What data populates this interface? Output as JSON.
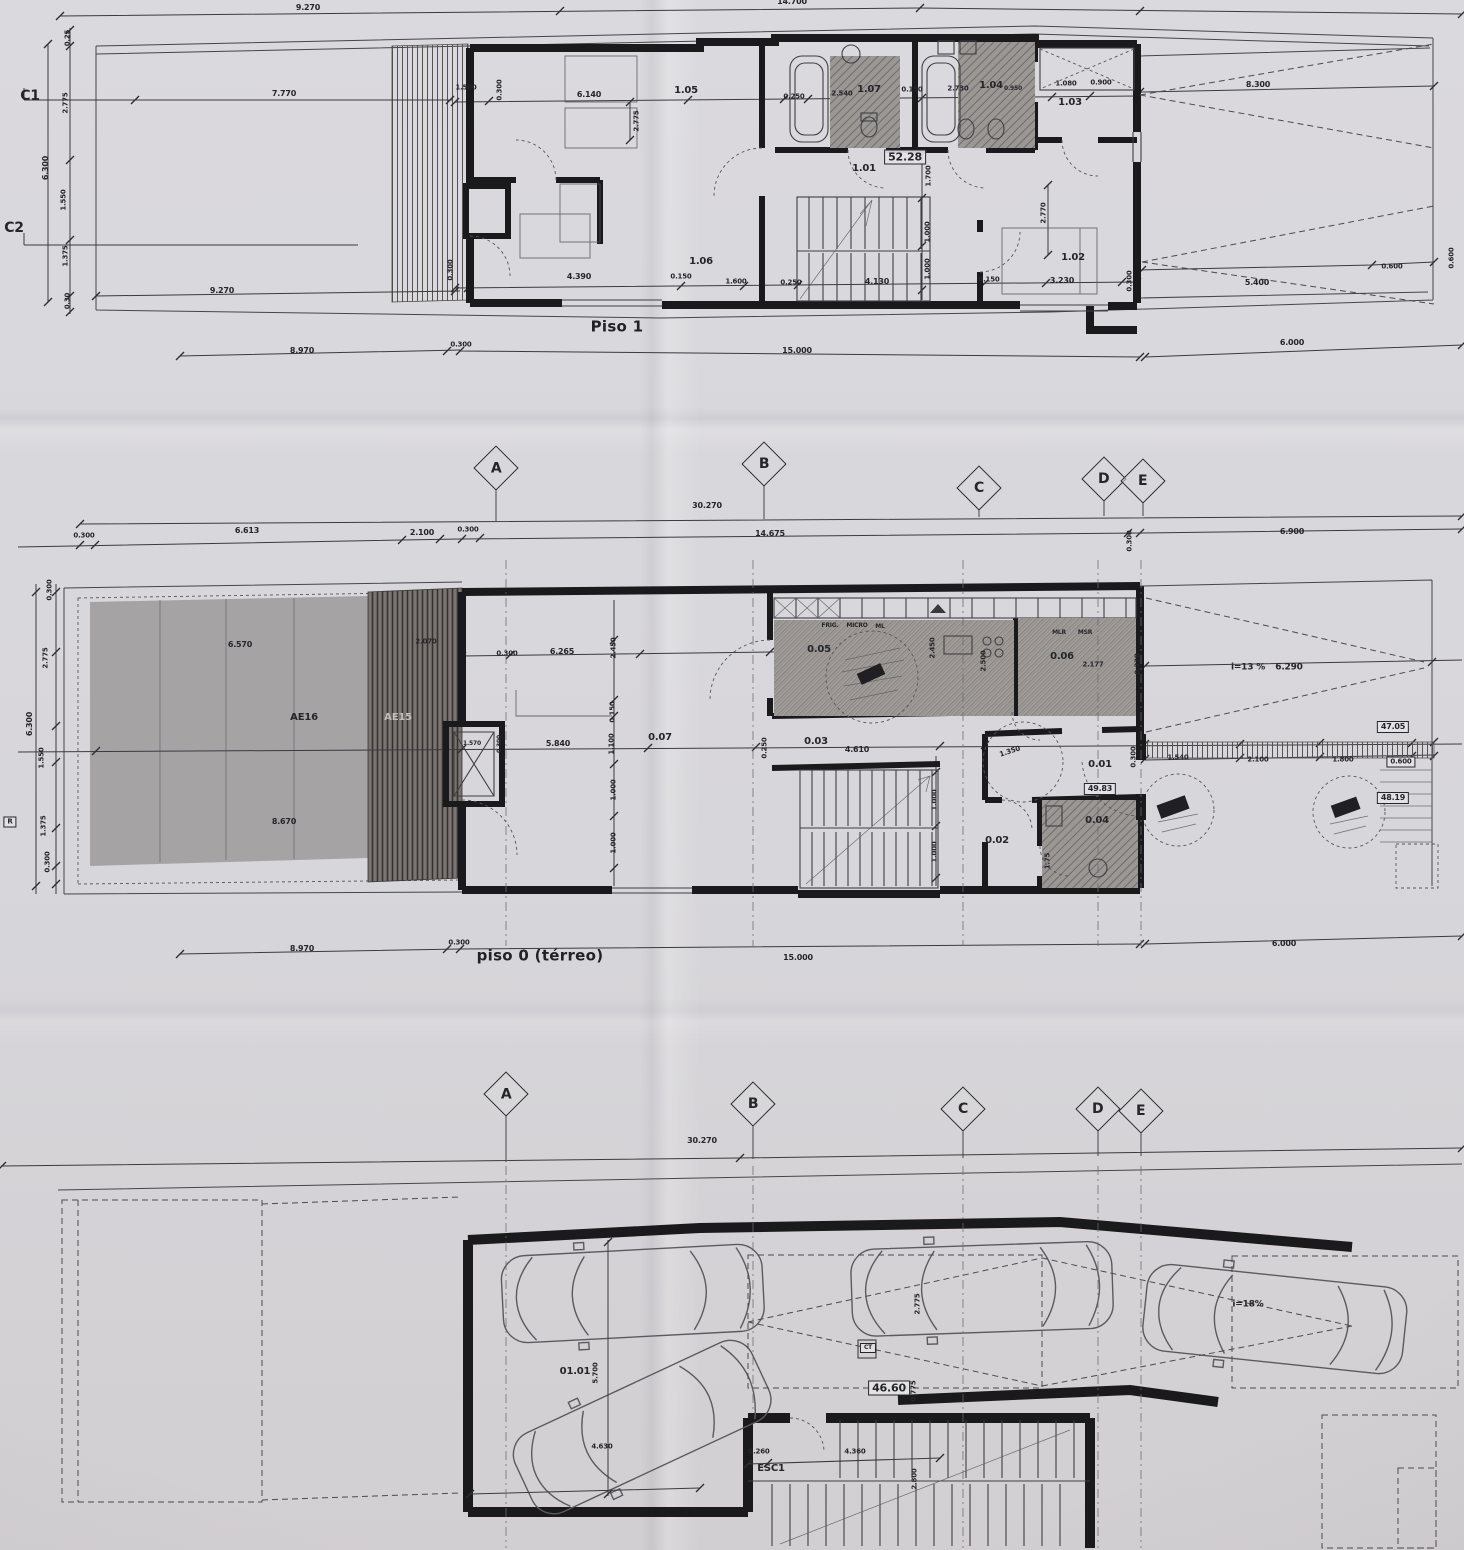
{
  "colors": {
    "paper": "#d8d7db",
    "ink": "#26262a",
    "wall": "#1a1a1c",
    "garden": "#a6a3a4",
    "deck": "#6e6966",
    "hatch": "#99948f"
  },
  "plans": {
    "piso1": {
      "title": "Piso 1",
      "rooms": [
        "1.01",
        "1.02",
        "1.03",
        "1.04",
        "1.05",
        "1.06",
        "1.07"
      ],
      "area": "52.28"
    },
    "piso0": {
      "title": "piso 0 (térreo)",
      "rooms": [
        "0.01",
        "0.02",
        "0.03",
        "0.04",
        "0.05",
        "0.06",
        "0.07"
      ],
      "zones": [
        "AE16",
        "AE15"
      ],
      "areas": [
        "49.83",
        "47.05",
        "48.19"
      ],
      "ramp_slope": "i=13 %"
    },
    "basement": {
      "rooms": [
        "01.01"
      ],
      "area": "46.60",
      "stairs": "ESC1",
      "ramp_slope": "i=18%"
    }
  },
  "grid_rows": [
    {
      "markers": [
        {
          "l": "A",
          "x": 496,
          "y": 468
        },
        {
          "l": "B",
          "x": 764,
          "y": 464
        },
        {
          "l": "C",
          "x": 979,
          "y": 488
        },
        {
          "l": "D",
          "x": 1104,
          "y": 479
        },
        {
          "l": "E",
          "x": 1143,
          "y": 481
        }
      ]
    },
    {
      "markers": [
        {
          "l": "A",
          "x": 506,
          "y": 1094
        },
        {
          "l": "B",
          "x": 753,
          "y": 1104
        },
        {
          "l": "C",
          "x": 963,
          "y": 1109
        },
        {
          "l": "D",
          "x": 1098,
          "y": 1109
        },
        {
          "l": "E",
          "x": 1141,
          "y": 1111
        }
      ]
    }
  ],
  "labels": [
    {
      "t": "9.270",
      "x": 308,
      "y": 8,
      "s": 8
    },
    {
      "t": "14.700",
      "x": 792,
      "y": 2,
      "s": 8
    },
    {
      "t": "C1",
      "x": 30,
      "y": 96,
      "s": 14,
      "n": "section-marker-c1"
    },
    {
      "t": "C2",
      "x": 14,
      "y": 228,
      "s": 14,
      "n": "section-marker-c2"
    },
    {
      "t": "0.25",
      "x": 68,
      "y": 38,
      "r": -90,
      "s": 7
    },
    {
      "t": "2.775",
      "x": 66,
      "y": 103,
      "r": -90,
      "s": 7
    },
    {
      "t": "6.300",
      "x": 46,
      "y": 168,
      "r": -90,
      "s": 8
    },
    {
      "t": "1.550",
      "x": 64,
      "y": 200,
      "r": -90,
      "s": 7
    },
    {
      "t": "1.375",
      "x": 66,
      "y": 256,
      "r": -90,
      "s": 7
    },
    {
      "t": "0.30",
      "x": 68,
      "y": 301,
      "r": -90,
      "s": 7
    },
    {
      "t": "7.770",
      "x": 284,
      "y": 94,
      "s": 8
    },
    {
      "t": "1.500",
      "x": 466,
      "y": 88,
      "s": 7
    },
    {
      "t": "0.300",
      "x": 500,
      "y": 90,
      "r": -90,
      "s": 7
    },
    {
      "t": "6.140",
      "x": 589,
      "y": 95,
      "s": 8
    },
    {
      "t": "1.05",
      "x": 686,
      "y": 91,
      "s": 10,
      "n": "room-label"
    },
    {
      "t": "2.775",
      "x": 637,
      "y": 121,
      "r": -90,
      "s": 7
    },
    {
      "t": "0.250",
      "x": 794,
      "y": 97,
      "s": 7
    },
    {
      "t": "2.540",
      "x": 842,
      "y": 94,
      "s": 7
    },
    {
      "t": "1.07",
      "x": 869,
      "y": 90,
      "s": 10,
      "n": "room-label"
    },
    {
      "t": "0.150",
      "x": 912,
      "y": 90,
      "s": 7
    },
    {
      "t": "2.730",
      "x": 958,
      "y": 89,
      "s": 7
    },
    {
      "t": "1.04",
      "x": 991,
      "y": 86,
      "s": 10,
      "n": "room-label"
    },
    {
      "t": "0.950",
      "x": 1013,
      "y": 89,
      "s": 6
    },
    {
      "t": "1.080",
      "x": 1066,
      "y": 84,
      "s": 7
    },
    {
      "t": "0.900",
      "x": 1101,
      "y": 83,
      "s": 7
    },
    {
      "t": "1.03",
      "x": 1070,
      "y": 103,
      "s": 10,
      "n": "room-label"
    },
    {
      "t": "52.28",
      "x": 905,
      "y": 157,
      "s": 11,
      "b": 1,
      "n": "area-badge"
    },
    {
      "t": "1.01",
      "x": 864,
      "y": 169,
      "s": 10,
      "n": "room-label"
    },
    {
      "t": "1.700",
      "x": 929,
      "y": 176,
      "r": -90,
      "s": 7
    },
    {
      "t": "2.770",
      "x": 1044,
      "y": 213,
      "r": -90,
      "s": 7
    },
    {
      "t": "1.000",
      "x": 928,
      "y": 232,
      "r": -90,
      "s": 7
    },
    {
      "t": "1.000",
      "x": 928,
      "y": 269,
      "r": -90,
      "s": 7
    },
    {
      "t": "1.02",
      "x": 1073,
      "y": 258,
      "s": 10,
      "n": "room-label"
    },
    {
      "t": "0.300",
      "x": 451,
      "y": 270,
      "r": -90,
      "s": 7
    },
    {
      "t": "4.390",
      "x": 579,
      "y": 277,
      "s": 8
    },
    {
      "t": "1.06",
      "x": 701,
      "y": 262,
      "s": 10,
      "n": "room-label"
    },
    {
      "t": "0.150",
      "x": 681,
      "y": 277,
      "s": 7
    },
    {
      "t": "1.600",
      "x": 736,
      "y": 282,
      "s": 7
    },
    {
      "t": "0.250",
      "x": 791,
      "y": 283,
      "s": 7
    },
    {
      "t": "4.130",
      "x": 877,
      "y": 282,
      "s": 8
    },
    {
      "t": "0.150",
      "x": 989,
      "y": 280,
      "s": 7
    },
    {
      "t": "3.230",
      "x": 1062,
      "y": 281,
      "s": 8
    },
    {
      "t": "0.300",
      "x": 1130,
      "y": 281,
      "r": -90,
      "s": 7
    },
    {
      "t": "8.300",
      "x": 1258,
      "y": 85,
      "s": 8
    },
    {
      "t": "5.400",
      "x": 1257,
      "y": 283,
      "s": 8
    },
    {
      "t": "0.600",
      "x": 1392,
      "y": 267,
      "s": 7
    },
    {
      "t": "0.600",
      "x": 1452,
      "y": 258,
      "r": -90,
      "s": 7
    },
    {
      "t": "9.270",
      "x": 222,
      "y": 291,
      "s": 8
    },
    {
      "t": "Piso 1",
      "x": 617,
      "y": 327,
      "s": 15,
      "n": "plan-title"
    },
    {
      "t": "8.970",
      "x": 302,
      "y": 351,
      "s": 8
    },
    {
      "t": "0.300",
      "x": 461,
      "y": 345,
      "s": 7
    },
    {
      "t": "15.000",
      "x": 797,
      "y": 351,
      "s": 8
    },
    {
      "t": "6.000",
      "x": 1292,
      "y": 343,
      "s": 8
    },
    {
      "t": "30.270",
      "x": 707,
      "y": 506,
      "s": 8
    },
    {
      "t": "0.300",
      "x": 84,
      "y": 536,
      "s": 7
    },
    {
      "t": "6.613",
      "x": 247,
      "y": 531,
      "s": 8
    },
    {
      "t": "2.100",
      "x": 422,
      "y": 533,
      "s": 8
    },
    {
      "t": "0.300",
      "x": 468,
      "y": 530,
      "s": 7
    },
    {
      "t": "14.675",
      "x": 770,
      "y": 534,
      "s": 8
    },
    {
      "t": "0.300",
      "x": 1130,
      "y": 541,
      "r": -90,
      "s": 7
    },
    {
      "t": "6.900",
      "x": 1292,
      "y": 532,
      "s": 8
    },
    {
      "t": "0.300",
      "x": 50,
      "y": 590,
      "r": -90,
      "s": 7
    },
    {
      "t": "2.775",
      "x": 46,
      "y": 658,
      "r": -90,
      "s": 7
    },
    {
      "t": "6.300",
      "x": 30,
      "y": 724,
      "r": -90,
      "s": 8
    },
    {
      "t": "1.550",
      "x": 42,
      "y": 758,
      "r": -90,
      "s": 7
    },
    {
      "t": "1.375",
      "x": 44,
      "y": 826,
      "r": -90,
      "s": 7
    },
    {
      "t": "0.300",
      "x": 48,
      "y": 862,
      "r": -90,
      "s": 7
    },
    {
      "t": "6.570",
      "x": 240,
      "y": 645,
      "s": 8
    },
    {
      "t": "2.070",
      "x": 426,
      "y": 642,
      "s": 7
    },
    {
      "t": "AE16",
      "x": 304,
      "y": 718,
      "s": 10,
      "n": "zone-label"
    },
    {
      "t": "AE15",
      "x": 398,
      "y": 718,
      "s": 10,
      "n": "zone-label",
      "light": 1
    },
    {
      "t": "8.670",
      "x": 284,
      "y": 822,
      "s": 8
    },
    {
      "t": "1.570",
      "x": 472,
      "y": 744,
      "s": 6
    },
    {
      "t": "0.300",
      "x": 500,
      "y": 744,
      "r": -90,
      "s": 6
    },
    {
      "t": "0.300",
      "x": 507,
      "y": 654,
      "s": 7
    },
    {
      "t": "6.265",
      "x": 562,
      "y": 652,
      "s": 8
    },
    {
      "t": "2.450",
      "x": 614,
      "y": 648,
      "r": -90,
      "s": 7
    },
    {
      "t": "0.150",
      "x": 613,
      "y": 712,
      "r": -90,
      "s": 7
    },
    {
      "t": "5.840",
      "x": 558,
      "y": 744,
      "s": 8
    },
    {
      "t": "1.100",
      "x": 612,
      "y": 744,
      "r": -90,
      "s": 7
    },
    {
      "t": "0.07",
      "x": 660,
      "y": 738,
      "s": 10,
      "n": "room-label"
    },
    {
      "t": "1.000",
      "x": 614,
      "y": 790,
      "r": -90,
      "s": 7
    },
    {
      "t": "1.000",
      "x": 614,
      "y": 843,
      "r": -90,
      "s": 7
    },
    {
      "t": "FRIG.",
      "x": 830,
      "y": 626,
      "s": 6
    },
    {
      "t": "MICRO",
      "x": 857,
      "y": 626,
      "s": 6
    },
    {
      "t": "ML",
      "x": 880,
      "y": 627,
      "s": 6
    },
    {
      "t": "0.05",
      "x": 819,
      "y": 650,
      "s": 10,
      "n": "room-label"
    },
    {
      "t": "2.450",
      "x": 933,
      "y": 648,
      "r": -90,
      "s": 7
    },
    {
      "t": "2.500",
      "x": 984,
      "y": 661,
      "r": -90,
      "s": 7
    },
    {
      "t": "MLR",
      "x": 1059,
      "y": 633,
      "s": 6
    },
    {
      "t": "MSR",
      "x": 1085,
      "y": 633,
      "s": 6
    },
    {
      "t": "0.06",
      "x": 1062,
      "y": 657,
      "s": 10,
      "n": "room-label"
    },
    {
      "t": "2.177",
      "x": 1093,
      "y": 665,
      "s": 7
    },
    {
      "t": "0.228",
      "x": 1138,
      "y": 664,
      "r": -90,
      "s": 7
    },
    {
      "t": "0.03",
      "x": 816,
      "y": 742,
      "s": 10,
      "n": "room-label"
    },
    {
      "t": "0.250",
      "x": 765,
      "y": 748,
      "r": -90,
      "s": 7
    },
    {
      "t": "4.610",
      "x": 857,
      "y": 750,
      "s": 8
    },
    {
      "t": "1.000",
      "x": 935,
      "y": 800,
      "r": -90,
      "s": 7
    },
    {
      "t": "1.000",
      "x": 935,
      "y": 852,
      "r": -90,
      "s": 7
    },
    {
      "t": "1.350",
      "x": 1010,
      "y": 752,
      "r": -18,
      "s": 7
    },
    {
      "t": "0.01",
      "x": 1100,
      "y": 765,
      "s": 10,
      "n": "room-label"
    },
    {
      "t": "49.83",
      "x": 1100,
      "y": 789,
      "s": 8,
      "b": 1,
      "n": "area-badge"
    },
    {
      "t": "0.04",
      "x": 1097,
      "y": 821,
      "s": 10,
      "n": "room-label"
    },
    {
      "t": "0.02",
      "x": 997,
      "y": 841,
      "s": 10,
      "n": "room-label"
    },
    {
      "t": "1.75",
      "x": 1048,
      "y": 861,
      "r": -90,
      "s": 7
    },
    {
      "t": "i=13 %",
      "x": 1248,
      "y": 668,
      "s": 9,
      "n": "ramp-slope-label"
    },
    {
      "t": "6.290",
      "x": 1289,
      "y": 668,
      "s": 9
    },
    {
      "t": "47.05",
      "x": 1393,
      "y": 727,
      "s": 8,
      "b": 1,
      "n": "area-badge"
    },
    {
      "t": "0.300",
      "x": 1134,
      "y": 757,
      "r": -90,
      "s": 7
    },
    {
      "t": "1.540",
      "x": 1178,
      "y": 758,
      "s": 7
    },
    {
      "t": "2.100",
      "x": 1258,
      "y": 760,
      "s": 7
    },
    {
      "t": "1.800",
      "x": 1343,
      "y": 760,
      "s": 7
    },
    {
      "t": "0.600",
      "x": 1401,
      "y": 762,
      "s": 7,
      "b": 1
    },
    {
      "t": "48.19",
      "x": 1393,
      "y": 798,
      "s": 8,
      "b": 1,
      "n": "area-badge"
    },
    {
      "t": "R",
      "x": 10,
      "y": 822,
      "s": 7,
      "b": 1
    },
    {
      "t": "8.970",
      "x": 302,
      "y": 949,
      "s": 8
    },
    {
      "t": "0.300",
      "x": 459,
      "y": 943,
      "s": 7
    },
    {
      "t": "piso 0 (térreo)",
      "x": 540,
      "y": 956,
      "s": 15,
      "n": "plan-title"
    },
    {
      "t": "15.000",
      "x": 798,
      "y": 958,
      "s": 8
    },
    {
      "t": "6.000",
      "x": 1284,
      "y": 944,
      "s": 8
    },
    {
      "t": "30.270",
      "x": 702,
      "y": 1141,
      "s": 8
    },
    {
      "t": "01.01",
      "x": 575,
      "y": 1372,
      "s": 10,
      "n": "room-label"
    },
    {
      "t": "5.700",
      "x": 596,
      "y": 1373,
      "r": -90,
      "s": 7
    },
    {
      "t": "4.630",
      "x": 602,
      "y": 1447,
      "s": 7
    },
    {
      "t": "0.260",
      "x": 759,
      "y": 1452,
      "s": 7
    },
    {
      "t": "ESC1",
      "x": 771,
      "y": 1469,
      "s": 10,
      "n": "stair-label"
    },
    {
      "t": "4.360",
      "x": 855,
      "y": 1452,
      "s": 7
    },
    {
      "t": "2.800",
      "x": 915,
      "y": 1479,
      "r": -90,
      "s": 7
    },
    {
      "t": "46.60",
      "x": 889,
      "y": 1388,
      "s": 11,
      "b": 1,
      "n": "area-badge"
    },
    {
      "t": "2.775",
      "x": 918,
      "y": 1304,
      "r": -90,
      "s": 7
    },
    {
      "t": "0.775",
      "x": 914,
      "y": 1391,
      "r": -90,
      "s": 7
    },
    {
      "t": "CT",
      "x": 868,
      "y": 1348,
      "s": 6,
      "b": 1
    },
    {
      "t": "i=18%",
      "x": 1248,
      "y": 1305,
      "s": 9,
      "n": "ramp-slope-label"
    }
  ]
}
